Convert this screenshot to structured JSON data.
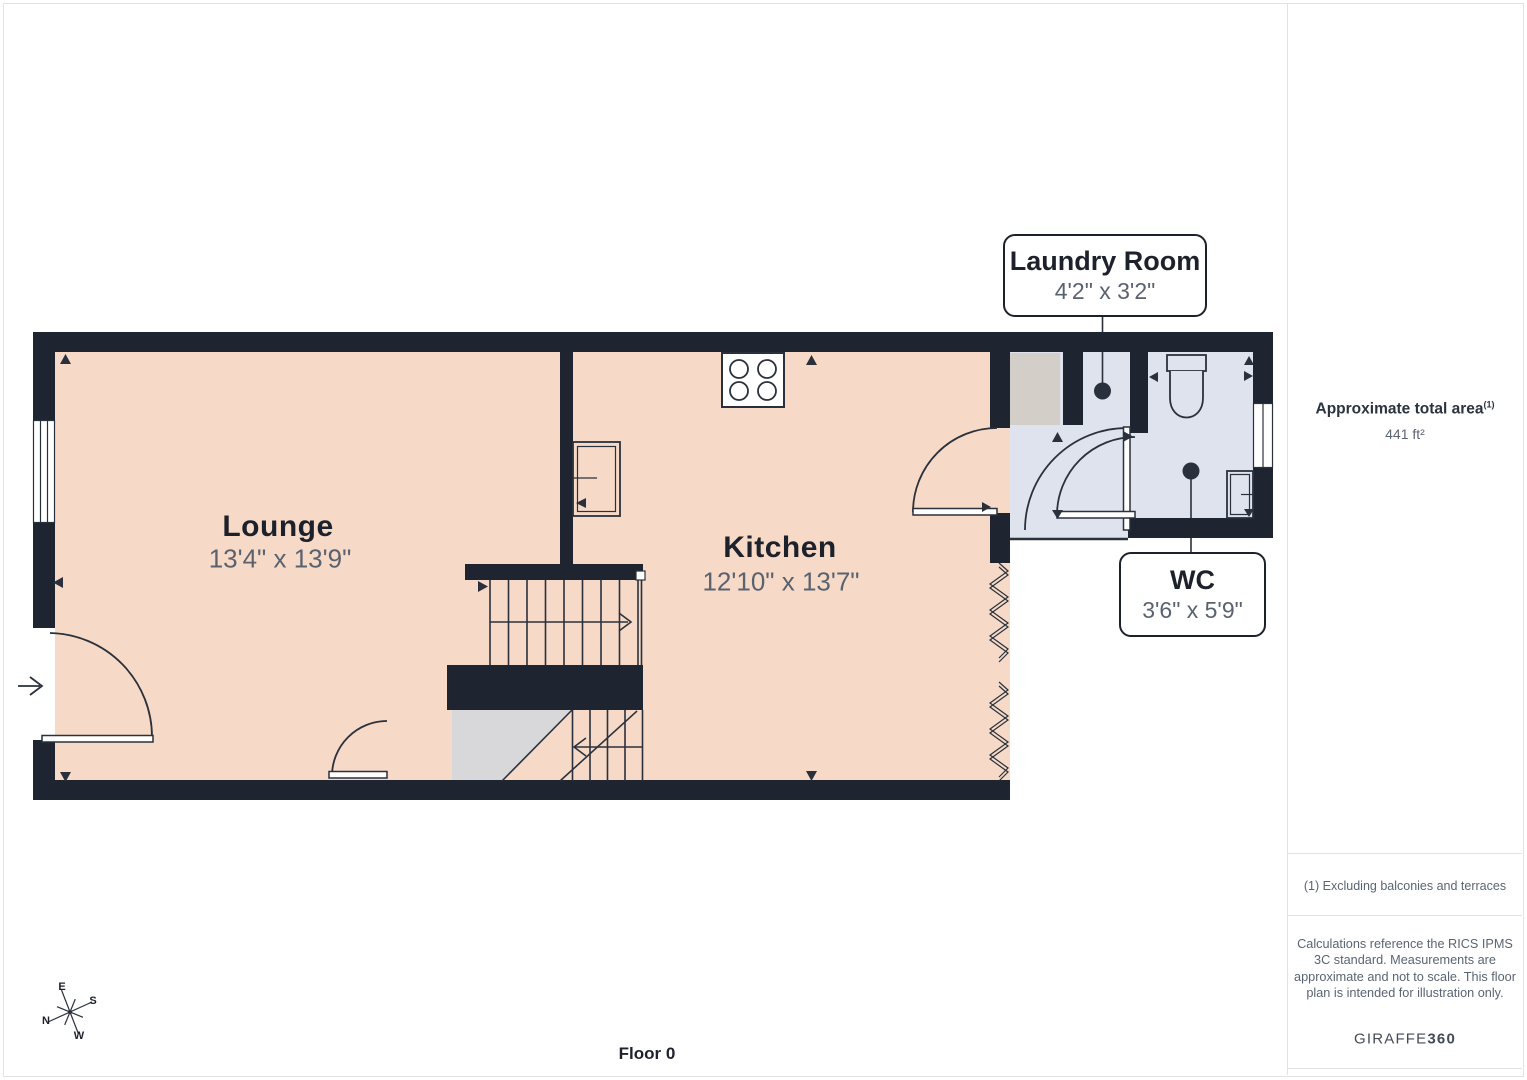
{
  "page": {
    "floor_label": "Floor 0"
  },
  "plan": {
    "rooms": [
      {
        "name": "Lounge",
        "dims": "13'4\" x 13'9\""
      },
      {
        "name": "Kitchen",
        "dims": "12'10\" x 13'7\""
      }
    ],
    "callouts": [
      {
        "name": "Laundry Room",
        "dims": "4'2\" x 3'2\""
      },
      {
        "name": "WC",
        "dims": "3'6\" x 5'9\""
      }
    ],
    "compass": {
      "n": "N",
      "e": "E",
      "s": "S",
      "w": "W"
    }
  },
  "sidebar": {
    "area_title": "Approximate total area",
    "area_sup": "(1)",
    "area_value": "441 ft²",
    "footnote": "(1) Excluding balconies and terraces",
    "disclaimer": "Calculations reference the RICS IPMS 3C standard. Measurements are approximate and not to scale. This floor plan is intended for illustration only.",
    "brand_name": "GIRAFFE",
    "brand_suffix": "360"
  },
  "colors": {
    "wall": "#1e2530",
    "room_fill": "#f6dac7",
    "wet_fill": "#dee3ee",
    "appliance_fill": "#d3cfc8",
    "under_stair_fill": "#d8d8da",
    "line": "#2a313c",
    "title_text": "#1d212b",
    "dim_text": "#5a6270",
    "muted_text": "#5a6472",
    "border": "#e3e3e3"
  }
}
